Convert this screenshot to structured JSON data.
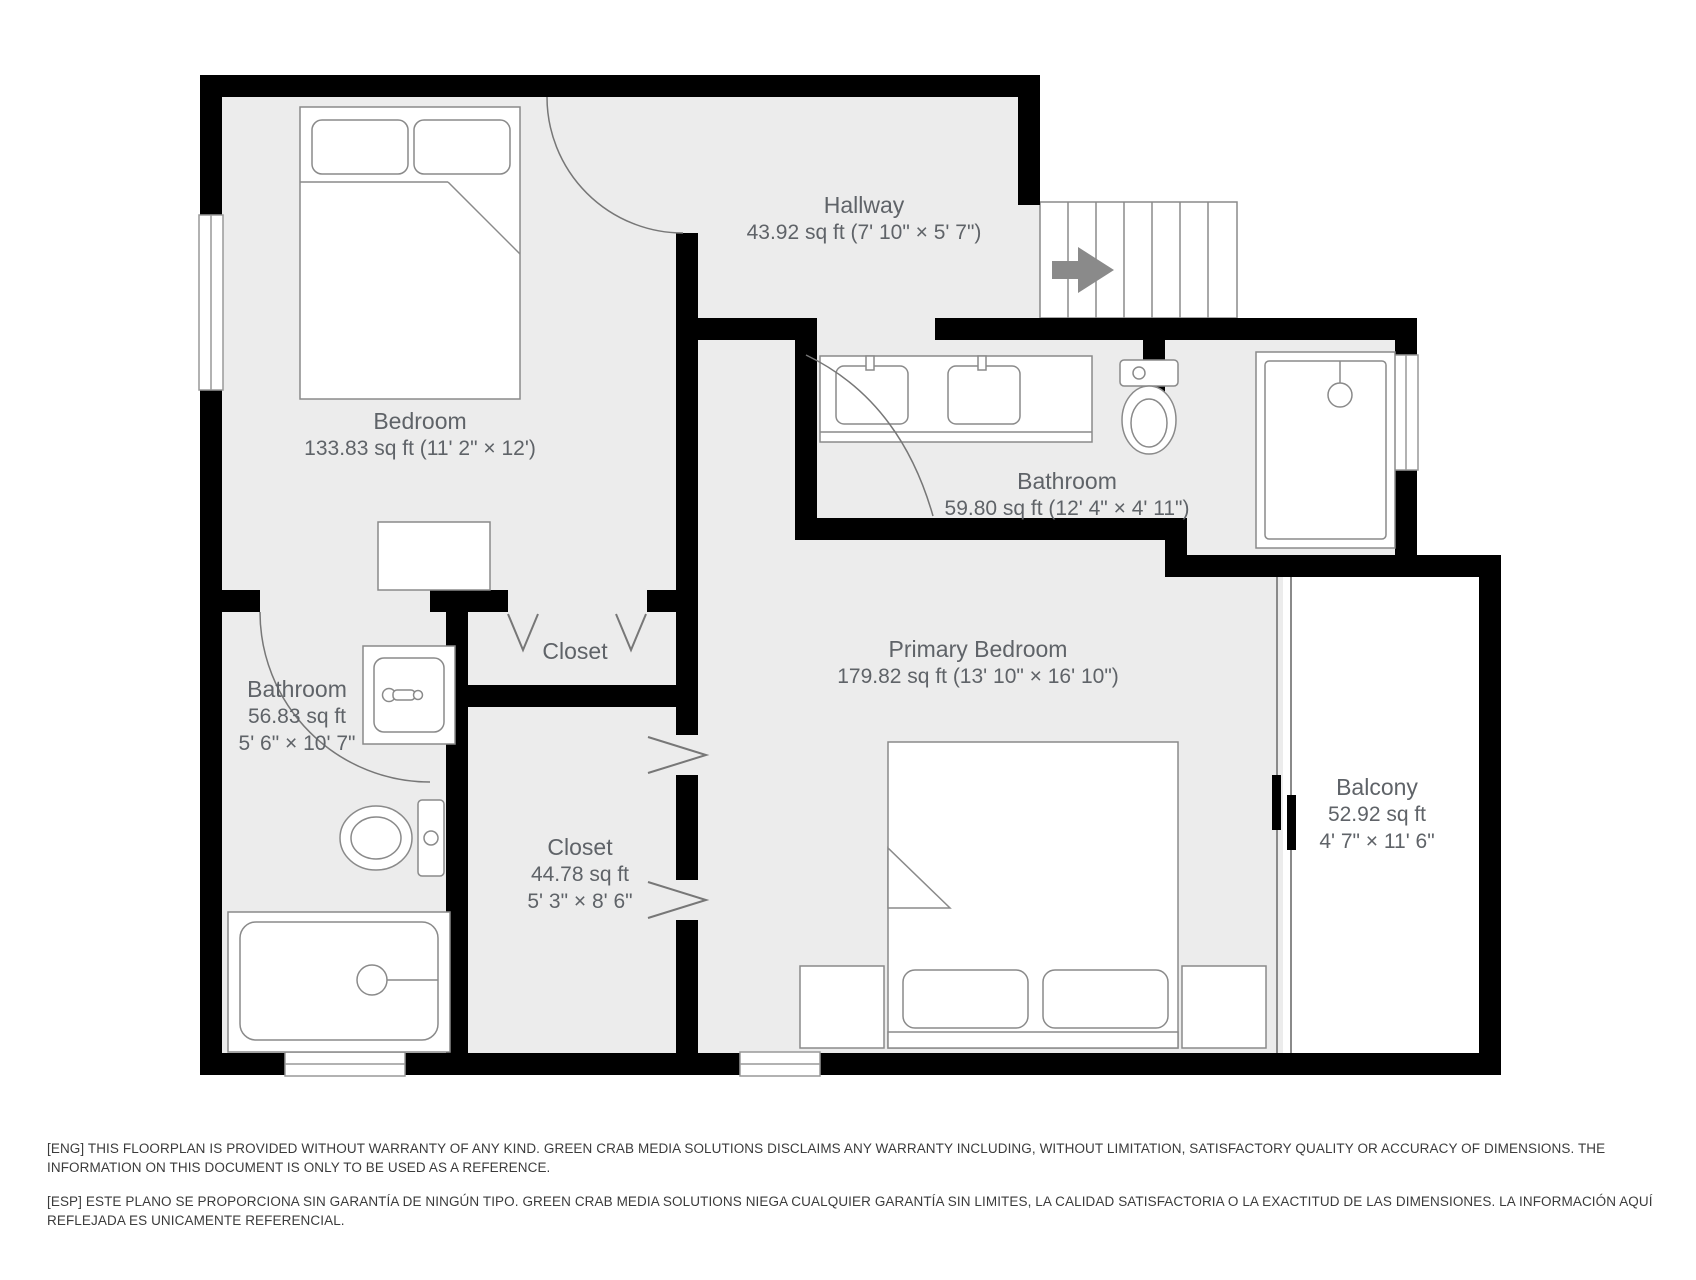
{
  "floorplan": {
    "rooms": {
      "bedroom": {
        "name": "Bedroom",
        "dims": "133.83 sq ft (11' 2\" × 12')"
      },
      "hallway": {
        "name": "Hallway",
        "dims": "43.92 sq ft (7' 10\" × 5' 7\")"
      },
      "bathroom_main": {
        "name": "Bathroom",
        "dims": "59.80 sq ft (12' 4\" × 4' 11\")"
      },
      "bathroom_left": {
        "name": "Bathroom",
        "area": "56.83 sq ft",
        "dims": "5' 6\" × 10' 7\""
      },
      "closet_upper": {
        "name": "Closet"
      },
      "closet_lower": {
        "name": "Closet",
        "area": "44.78 sq ft",
        "dims": "5' 3\" × 8' 6\""
      },
      "primary_bedroom": {
        "name": "Primary Bedroom",
        "dims": "179.82 sq ft (13' 10\" × 16' 10\")"
      },
      "balcony": {
        "name": "Balcony",
        "area": "52.92 sq ft",
        "dims": "4' 7\" × 11' 6\""
      }
    },
    "icons": {
      "stairs_direction": "right-arrow"
    },
    "colors": {
      "wall": "#000000",
      "floor": "#ececec",
      "fixture_outline": "#8a8a8a",
      "label_text": "#5f6368",
      "disclaimer_text": "#3b3b3b",
      "stairs_arrow": "#8a8a8a"
    }
  },
  "disclaimer": {
    "eng": "[ENG] THIS FLOORPLAN IS PROVIDED WITHOUT WARRANTY OF ANY KIND. GREEN CRAB MEDIA SOLUTIONS DISCLAIMS ANY WARRANTY INCLUDING, WITHOUT LIMITATION, SATISFACTORY QUALITY OR ACCURACY OF DIMENSIONS. THE INFORMATION ON THIS DOCUMENT IS ONLY TO BE USED AS A REFERENCE.",
    "esp": "[ESP] ESTE PLANO SE PROPORCIONA SIN GARANTÍA DE NINGÚN TIPO. GREEN CRAB MEDIA SOLUTIONS NIEGA CUALQUIER GARANTÍA SIN LIMITES, LA CALIDAD SATISFACTORIA O LA EXACTITUD DE LAS DIMENSIONES. LA INFORMACIÓN AQUÍ REFLEJADA ES UNICAMENTE REFERENCIAL."
  }
}
